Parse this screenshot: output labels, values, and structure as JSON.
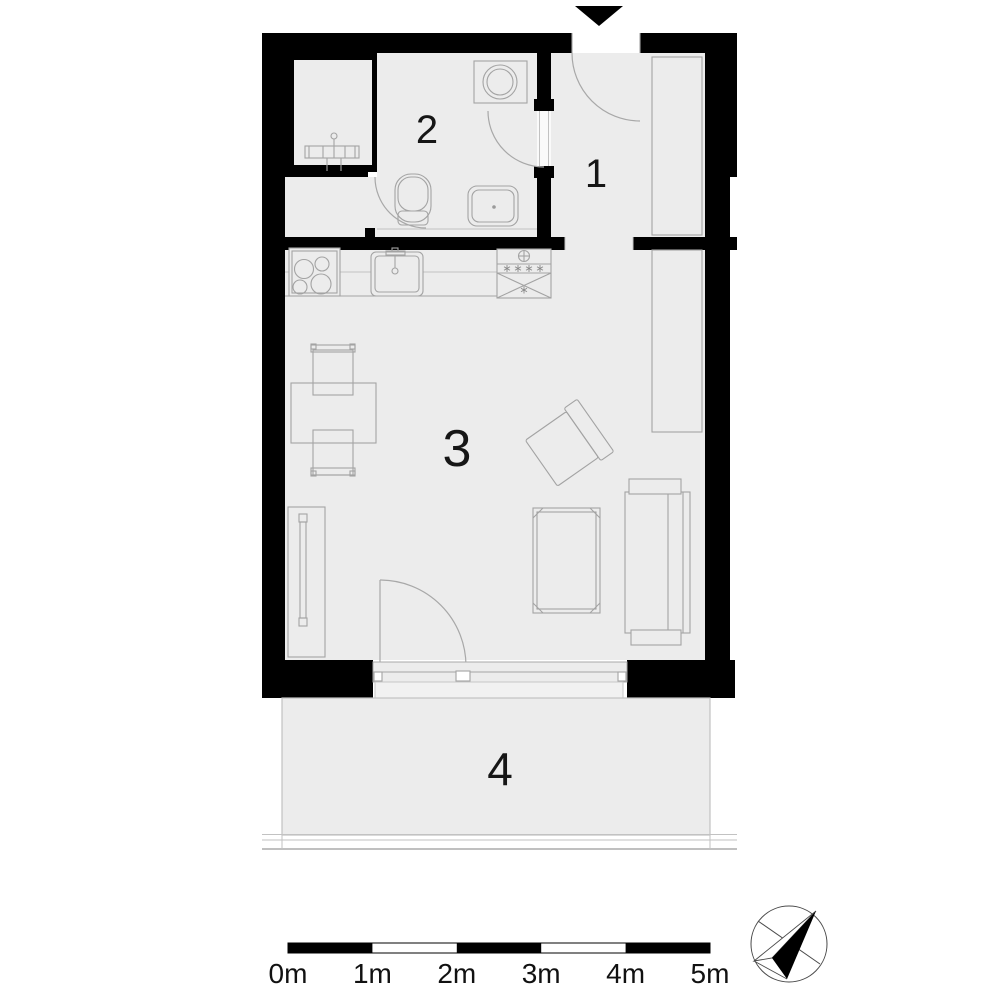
{
  "floor_plan": {
    "rooms": [
      {
        "label": "1"
      },
      {
        "label": "2"
      },
      {
        "label": "3"
      },
      {
        "label": "4"
      }
    ],
    "scale_bar": {
      "unit_labels": [
        "0m",
        "1m",
        "2m",
        "3m",
        "4m",
        "5m"
      ]
    },
    "icons": {
      "entrance_arrow": "black triangle pointing down at main entry",
      "north_compass": "compass rose with black needle pointing upper-right"
    },
    "colors": {
      "wall": "#000000",
      "floor": "#ececec",
      "outline": "#a3a3a3",
      "background": "#ffffff"
    }
  }
}
